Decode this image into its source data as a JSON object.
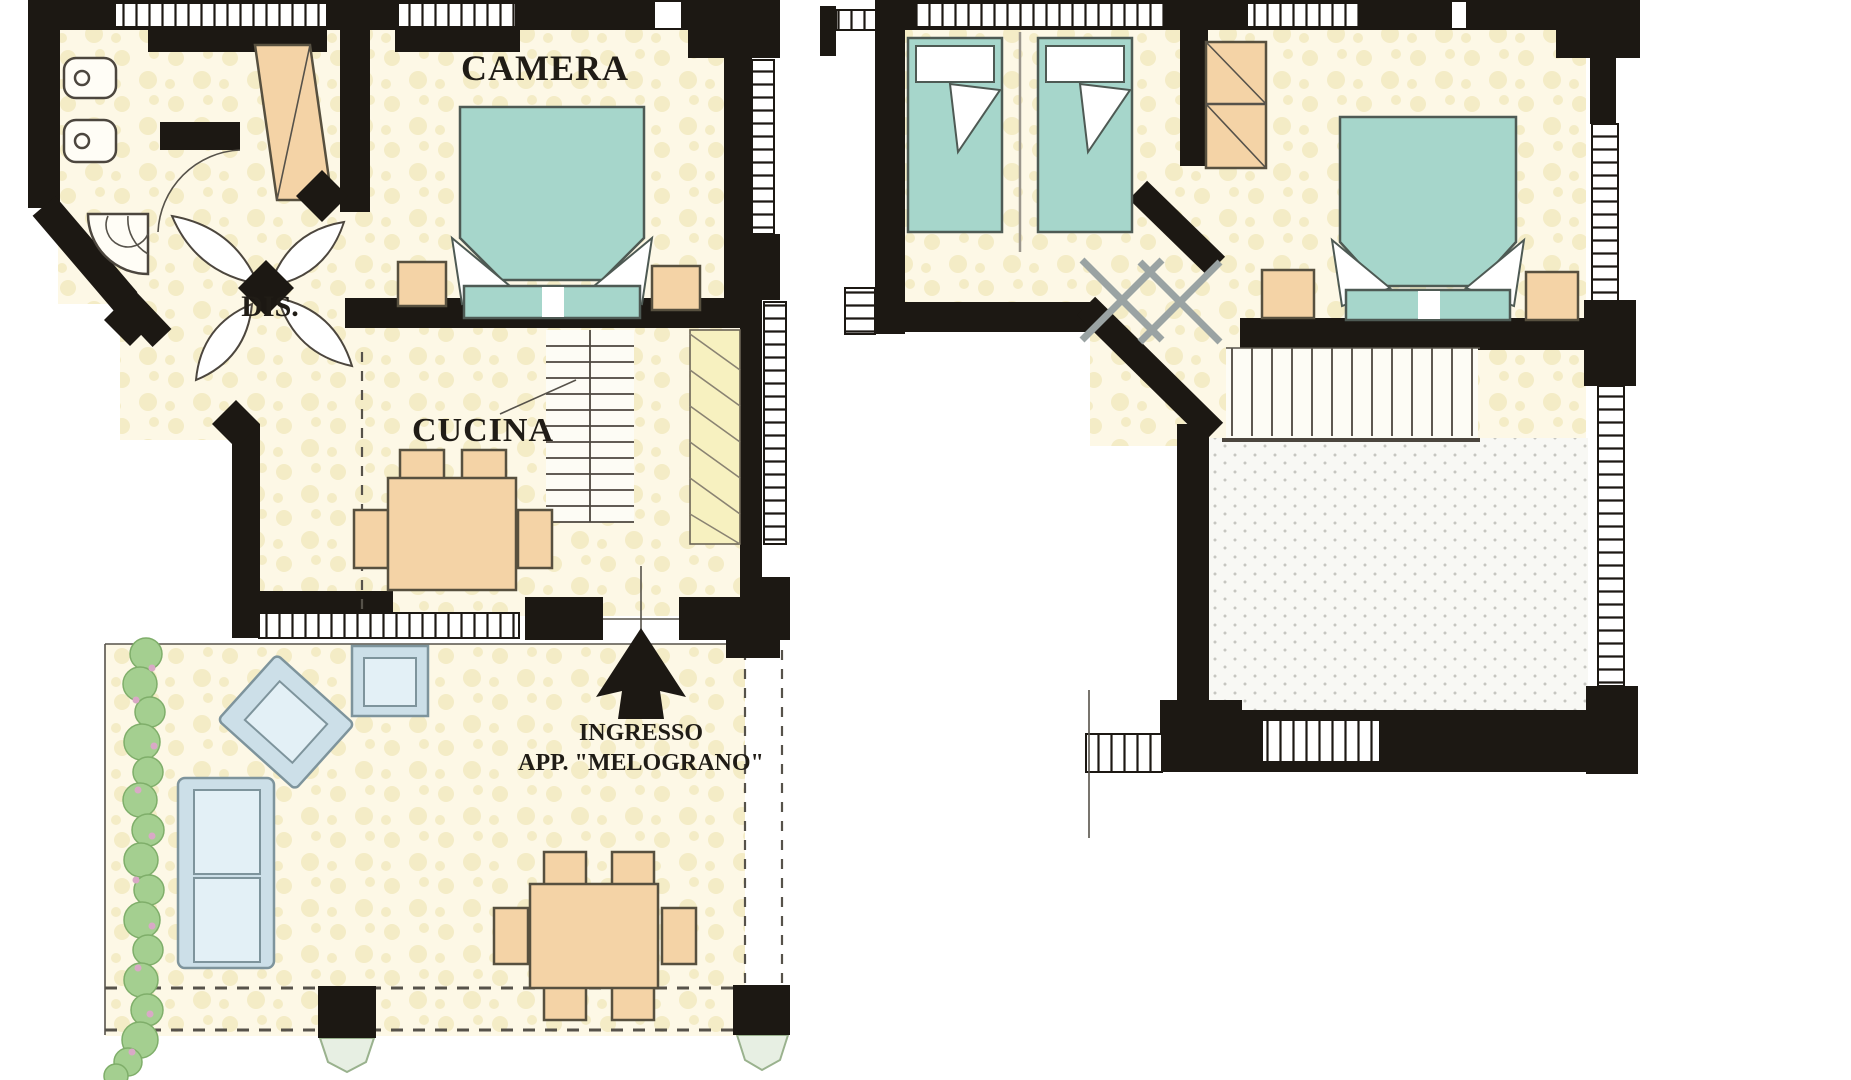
{
  "plans": {
    "ground_floor": {
      "name": "ground floor",
      "rooms": [
        {
          "id": "camera",
          "label": "CAMERA"
        },
        {
          "id": "dis",
          "label": "DIS."
        },
        {
          "id": "cucina",
          "label": "CUCINA"
        }
      ],
      "entrance": {
        "line1": "INGRESSO",
        "line2": "APP. \"MELOGRANO\""
      }
    },
    "upper_floor": {
      "name": "upper floor",
      "rooms": []
    }
  },
  "colors": {
    "wall": "#1c1813",
    "floor": "#fdf8e6",
    "floor_speckle": "#f4ecc6",
    "bed": "#a6d6cb",
    "bed_outline": "#4e5a54",
    "furniture_peach": "#f4d3a6",
    "furniture_outline": "#57503f",
    "seat_frame": "#ccdfe8",
    "seat_cushion": "#e3f0f6",
    "seat_outline": "#7e949c",
    "hedge": "#a4cf90",
    "hedge_outline": "#7fae6a",
    "flower": "#d9a9c6",
    "stair_hatch": "#f7f1c0",
    "stipple_dot": "#c6c6c0",
    "door_leaf": "#ffffff",
    "door_gray": "#9aa3a3",
    "thin_line": "#56524a"
  }
}
